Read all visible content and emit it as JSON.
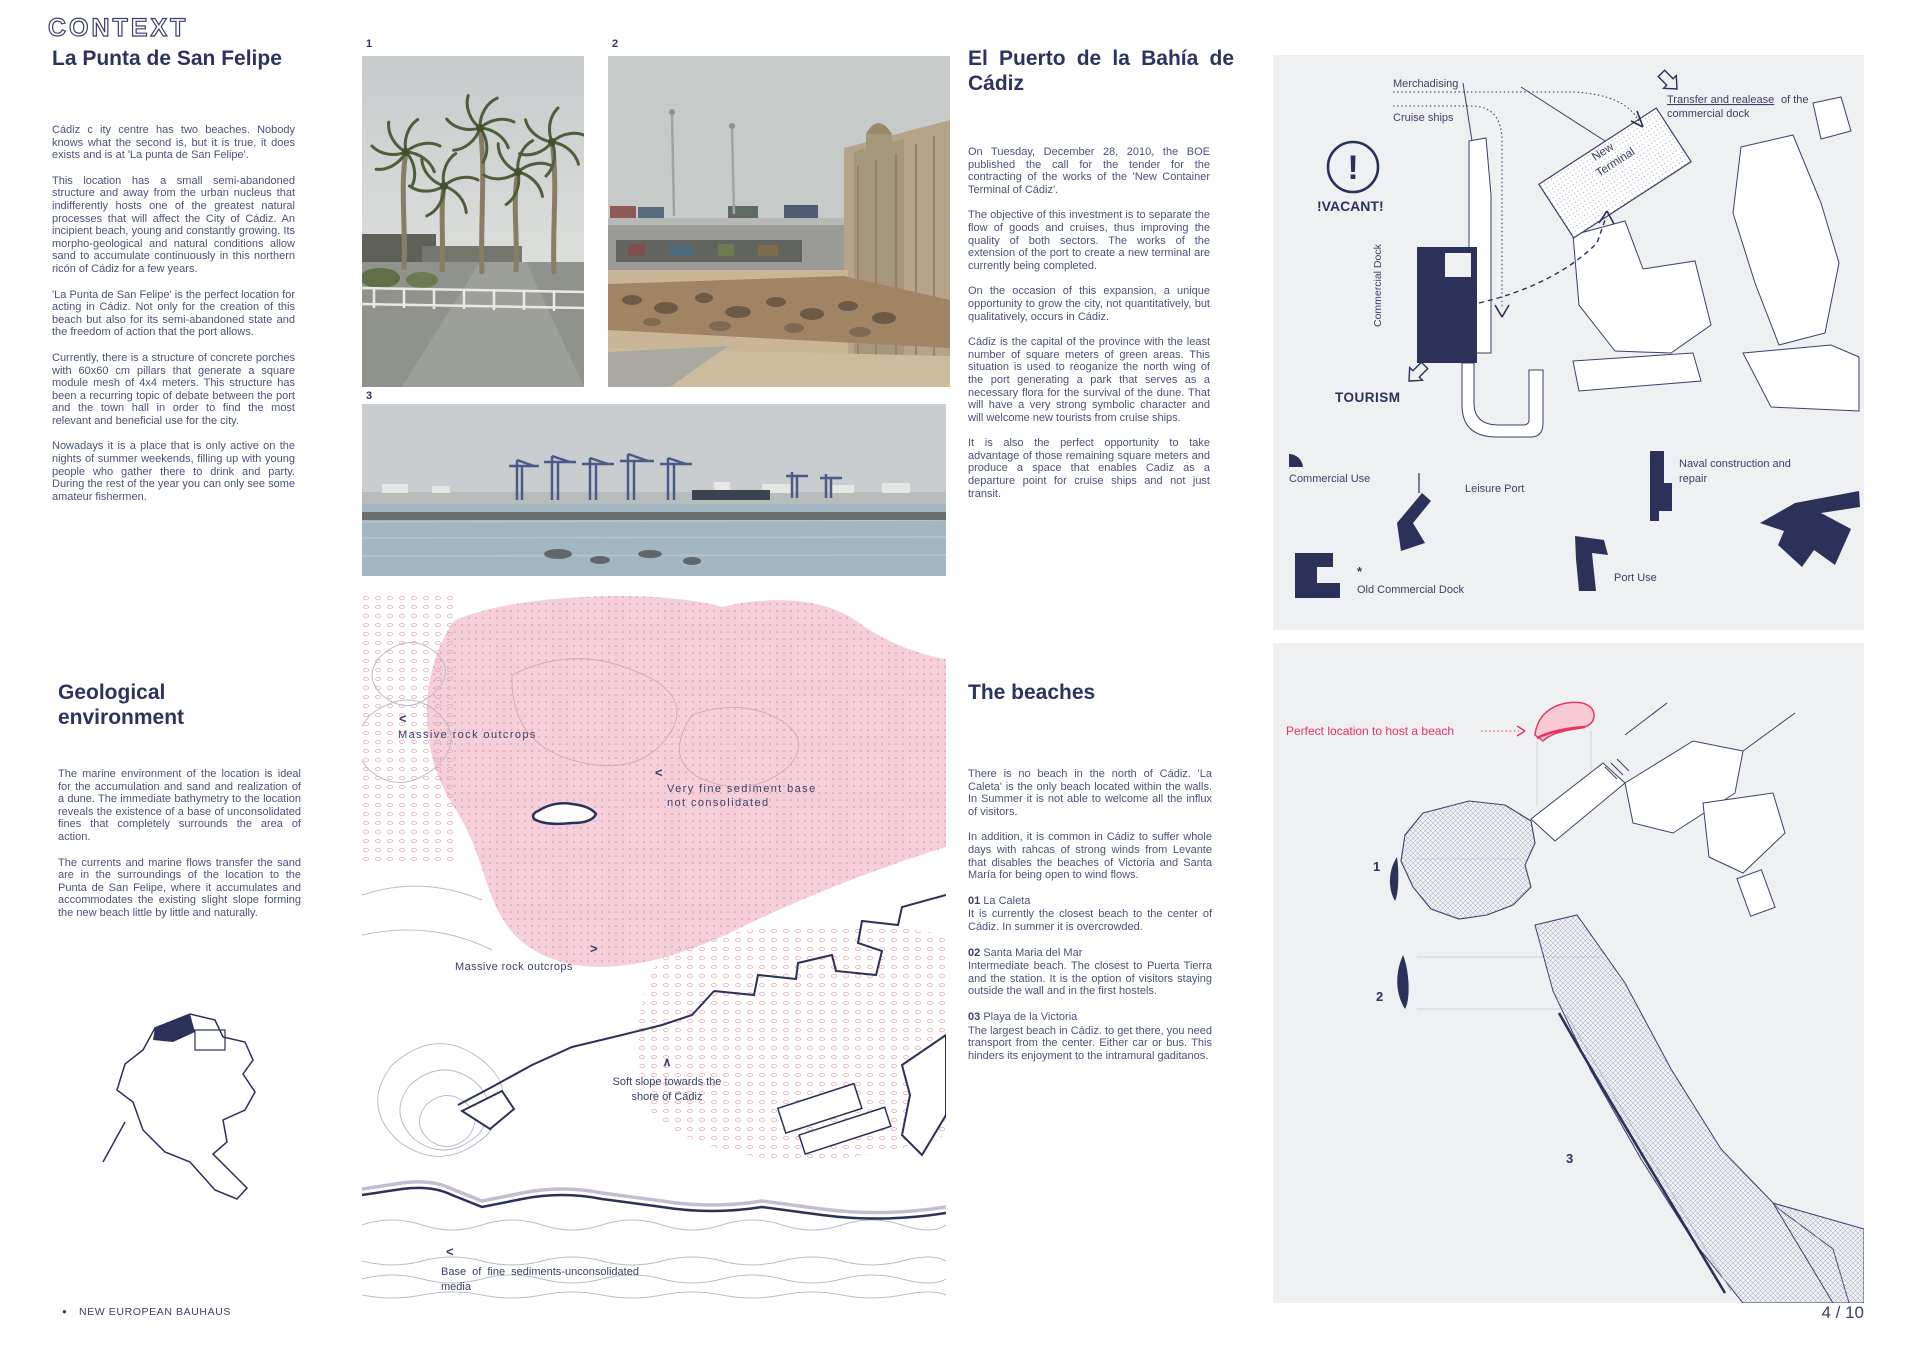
{
  "header": {
    "title": "CONTEXT"
  },
  "colors": {
    "navy": "#2b3158",
    "body_text": "#4a5278",
    "panel_bg": "#eef0f2",
    "accent_pink": "#e73360"
  },
  "la_punta": {
    "heading": "La Punta de San Felipe",
    "p": [
      "Cádiz c ity centre has two beaches. Nobody knows what the second is, but it is true, it does exists and is at 'La punta de San Felipe'.",
      "This location has a small semi-abandoned structure and away from the urban nucleus that indifferently hosts one of the greatest natural processes that will affect the City of Cádiz. An incipient beach, young and constantly growing. Its morpho-geological and natural conditions allow sand to accumulate continuously in this northern ricón of Cádiz for a few years.",
      "'La Punta de San Felipe' is the perfect location for acting in Cádiz. Not only for the creation of this beach but also for its semi-abandoned state and the freedom of action that the port allows.",
      "Currently, there is a structure of concrete porches with 60x60 cm pillars that generate a square module mesh of 4x4 meters. This structure has been a recurring topic of debate between the port and the town hall in order to find the most relevant and beneficial use for the city.",
      "Nowadays it is a place that is only active on the nights of summer weekends, filling up with young people who gather there to drink and party. During the rest of the year you can only see some amateur fishermen."
    ]
  },
  "el_puerto": {
    "h1": "El Puerto de la Bahía de",
    "h2": "Cádiz",
    "p": [
      "On Tuesday, December 28, 2010, the BOE published the call for the tender for the contracting of the works of the 'New Container Terminal of Cádiz'.",
      "The objective of this investment is to separate the flow of goods and cruises, thus improving the quality of both sectors. The works of the extension of the port to create a new terminal are currently being completed.",
      "On the occasion of this expansion, a unique opportunity to grow the city, not quantitatively, but qualitatively, occurs in Cádiz.",
      "Cádiz is the capital of the province with the least number of square meters of green areas. This situation is used to reoganize the north wing of the port generating a park that serves as a necessary flora for the survival of the dune. That will have a very strong symbolic character and will welcome new tourists from cruise ships.",
      "It is also the perfect opportunity to take advantage of those remaining square meters and produce a space that enables Cadiz as a departure point for cruise ships and not just transit."
    ]
  },
  "geological": {
    "h1": "Geological",
    "h2": "environment",
    "p": [
      "The marine environment of the location is ideal for the accumulation and sand and realization of a dune. The immediate bathymetry to the location reveals the existence of a base of unconsolidated fines that completely surrounds the area of action.",
      "The currents and marine flows transfer the sand are in the surroundings of the location to the Punta de San Felipe, where it accumulates and accommodates the existing slight slope forming the new beach little by little and naturally."
    ]
  },
  "beaches": {
    "heading": "The beaches",
    "p": [
      "There is no beach in the north of Cádiz. 'La Caleta' is the only beach located within the walls. In Summer it is not able to welcome all the influx of visitors.",
      "In addition, it is common in Cádiz to suffer whole days with rahcas of strong winds from Levante that disables the beaches of Victoria and Santa María for being open to wind flows."
    ],
    "items": [
      {
        "num": "01",
        "name": "La Caleta",
        "desc": "It is currently the closest beach to the center of Cádiz. In summer it is overcrowded."
      },
      {
        "num": "02",
        "name": "Santa Maria del Mar",
        "desc": "Intermediate beach. The closest to Puerta Tierra and the station. It is the option of visitors staying outside the wall and in the first hostels."
      },
      {
        "num": "03",
        "name": "Playa de la Victoria",
        "desc": "The largest beach in Cádiz. to get there, you need transport from the center. Either car or bus. This hinders its enjoyment to the intramural gaditanos."
      }
    ]
  },
  "photos": {
    "l1": "1",
    "l2": "2",
    "l3": "3"
  },
  "port_diagram": {
    "merchandising": "Merchadising",
    "cruise_ships": "Cruise ships",
    "transfer_u": "Transfer and realease",
    "transfer_rest": "of the",
    "transfer_l2": "commercial dock",
    "new_terminal_l1": "New",
    "new_terminal_l2": "Terminal",
    "vacant": "!VACANT!",
    "vacant_mark": "!",
    "commercial_dock": "Commercial Dock",
    "tourism": "TOURISM",
    "commercial_use": "Commercial Use",
    "leisure_port": "Leisure Port",
    "naval_l1": "Naval construction and",
    "naval_l2": "repair",
    "asterisk": "*",
    "old_commercial_dock": "Old Commercial Dock",
    "port_use": "Port Use"
  },
  "geo_map": {
    "arrow_left": "<",
    "arrow_right": ">",
    "arrow_up": "∧",
    "rock_top": "Massive rock outcrops",
    "sediment_l1": "Very fine sediment base",
    "sediment_l2": "not consolidated",
    "rock_mid": "Massive rock outcrops",
    "slope_l1": "Soft slope towards the",
    "slope_l2": "shore of Cádiz",
    "base_l1": "Base of fine sediments-unconsolidated",
    "base_l2": "media"
  },
  "city_map": {
    "highlight": "Perfect location to host a beach",
    "m1": "1",
    "m2": "2",
    "m3": "3"
  },
  "footer": {
    "bullet": "●",
    "brand": "NEW EUROPEAN BAUHAUS",
    "page": "4 / 10"
  }
}
